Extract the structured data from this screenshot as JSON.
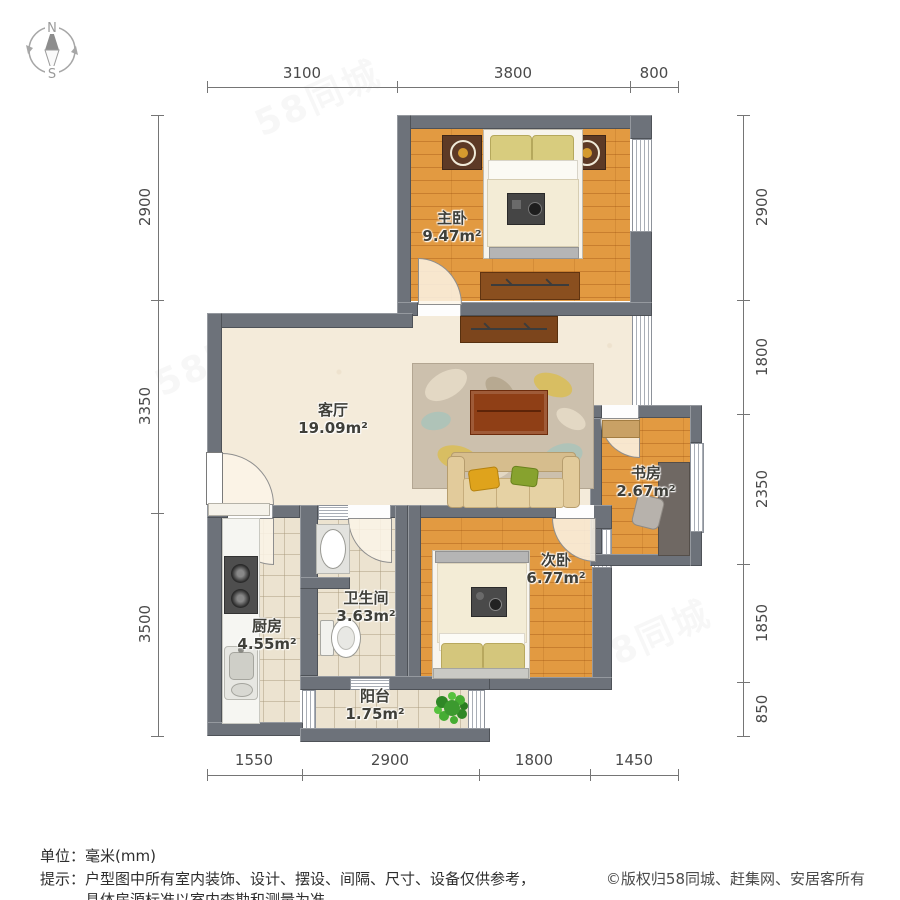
{
  "compass": {
    "north": "N",
    "south": "S"
  },
  "watermark": {
    "text": "58同城"
  },
  "rooms": {
    "master": {
      "name": "主卧",
      "area": "9.47m²"
    },
    "living": {
      "name": "客厅",
      "area": "19.09m²"
    },
    "study": {
      "name": "书房",
      "area": "2.67m²"
    },
    "second": {
      "name": "次卧",
      "area": "6.77m²"
    },
    "bath": {
      "name": "卫生间",
      "area": "3.63m²"
    },
    "kitchen": {
      "name": "厨房",
      "area": "4.55m²"
    },
    "balcony": {
      "name": "阳台",
      "area": "1.75m²"
    }
  },
  "dimensions": {
    "top": [
      "3100",
      "3800",
      "800"
    ],
    "bottom": [
      "1550",
      "2900",
      "1800",
      "1450"
    ],
    "left": [
      "2900",
      "3350",
      "3500"
    ],
    "right": [
      "2900",
      "1800",
      "2350",
      "1850",
      "850"
    ]
  },
  "footer": {
    "unit_label": "单位：",
    "unit_value": "毫米(mm)",
    "tip_label": "提示：",
    "tip_line1": "户型图中所有室内装饰、设计、摆设、间隔、尺寸、设备仅供参考，",
    "tip_line2": "具体房源标准以室内查勘和测量为准。",
    "copyright": "©版权归58同城、赶集网、安居客所有"
  },
  "colors": {
    "wall": "#6d727a",
    "wood_floor": "#e29a41",
    "tile_floor": "#ece3d0",
    "living_floor": "#f4ebda",
    "cabinet": "#7c451c",
    "sofa": "#dcc393",
    "pillow_yellow": "#dfa31c",
    "pillow_green": "#87a22e",
    "plant": "#3c9a2f"
  }
}
